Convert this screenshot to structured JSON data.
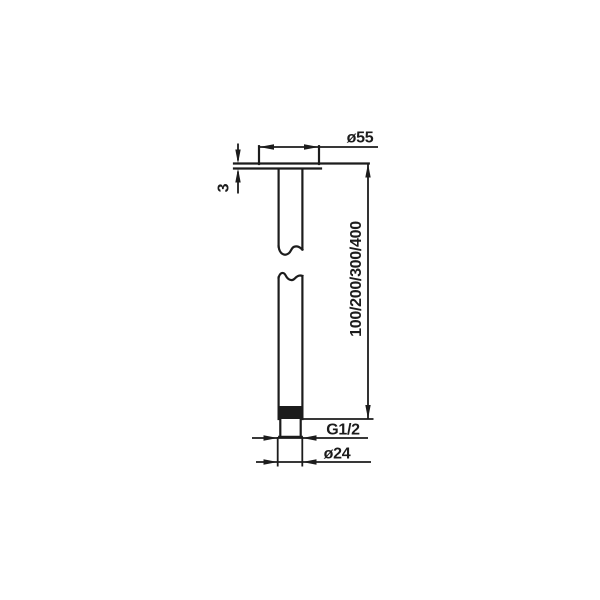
{
  "page": {
    "background": "#ffffff",
    "line_color": "#1c1c1c"
  },
  "drawing": {
    "kind": "technical-dimension-drawing",
    "subject": "ceiling-mounted shower arm, side elevation with break lines",
    "labels": {
      "flange_diameter": "ø55",
      "flange_thickness": "3",
      "arm_length": "100/200/300/400",
      "thread_size": "G1/2",
      "pipe_diameter": "ø24"
    }
  }
}
